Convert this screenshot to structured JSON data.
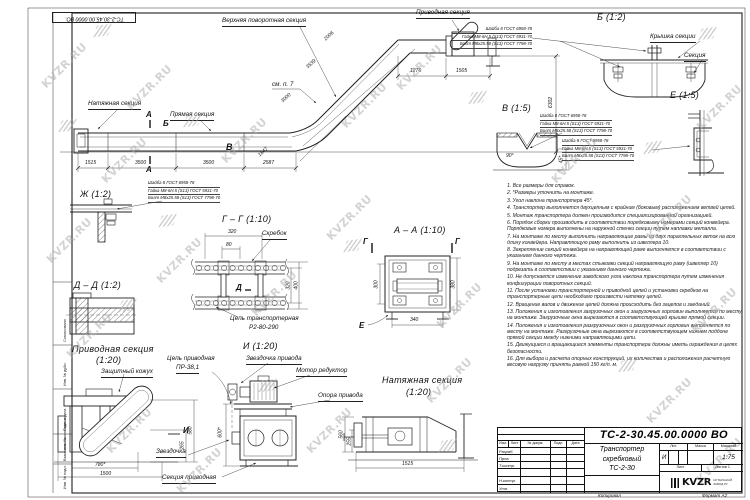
{
  "sheet": {
    "stamp_number": "ТС-2-30.45.00.0000 ВО.",
    "copied_label": "Копировал",
    "format_label": "Формат А2"
  },
  "watermark": {
    "text": "KVZR.RU"
  },
  "margin_labels": {
    "agreed": "Согласовано",
    "inv_dup": "Инв. № дубл.",
    "sign_date": "Подп. и дата",
    "repl_inv": "Взам. инв. №",
    "inv_orig": "Инв. № подл."
  },
  "main_view": {
    "tension_label": "Натяжная секция",
    "straight_label": "Прямая секция",
    "upper_turn_label": "Верхняя поворотная секция",
    "drive_label": "Приводная секция",
    "see_note": "см. п. 7",
    "mark_a": "А",
    "mark_b": "Б",
    "mark_v": "В",
    "dims": {
      "d1515": "1515",
      "d3500a": "3500",
      "d3500b": "3500",
      "d2587": "2587",
      "d1847": "1847",
      "d3000": "3000",
      "d3539": "3539",
      "d2006": "2006",
      "d1276": "1276",
      "d1505": "1505",
      "d6302": "6302"
    }
  },
  "fasteners": {
    "washer": "Шайба 8 ГОСТ 6958-78",
    "nut": "Гайка М8-6Н.5 (S13) ГОСТ 5931-70",
    "bolt": "Болт М8х25.58 (S13) ГОСТ 7798-70"
  },
  "details": {
    "b": {
      "title": "Б (1:2)",
      "cover_label": "Крышка секции",
      "section_label": "Секция"
    },
    "v": {
      "title": "В (1:5)",
      "angle90": "90°",
      "dim45": "45*"
    },
    "e": {
      "title": "Е (1:5)"
    },
    "zh": {
      "title": "Ж (1:2)"
    },
    "dd": {
      "title": "Д – Д (1:2)"
    },
    "gg": {
      "title": "Г – Г (1:10)",
      "scraper_label": "Скребок",
      "chain_label1": "Цепь транспортерная",
      "chain_label2": "Р2-80-290",
      "mark_d": "Д",
      "dim_w": "320",
      "dim_w2": "80",
      "dim_h1": "320",
      "dim_h2": "400"
    },
    "aa": {
      "title": "А – А (1:10)",
      "mark_g1": "Г",
      "mark_g2": "Г",
      "mark_e": "Е",
      "dim_left": "300",
      "dim_right": "380",
      "dim_bottom": "340"
    },
    "i": {
      "title": "И (1:20)",
      "chain_label1": "Цепь приводная",
      "chain_label2": "ПР-38,1",
      "drive_sprocket_label": "Звездочка привода",
      "motor_label": "Мотор редуктор",
      "support_label": "Опора привода",
      "sprocket_label": "Звездочка",
      "drive_section_label": "Секция приводная",
      "dim_h": "600*"
    },
    "drive_view": {
      "title": "Приводная секция",
      "scale": "(1:20)",
      "guard_label": "Защитный кожух",
      "mark_i": "И",
      "dim1": "780*",
      "dim2": "1500",
      "dim3": "265",
      "dim4": "560"
    },
    "tension_view": {
      "title": "Натяжная секция",
      "scale": "(1:20)",
      "dim1": "560",
      "dim2": "255",
      "dim3": "1515"
    }
  },
  "notes": [
    "1. Все размеры для справок.",
    "2. *Размеры уточнить на монтаже.",
    "3. Угол наклона транспортера 45°.",
    "4. Транспортер выполняется двухцепным с крайним (боковым) расположением ветвей цепей.",
    "5. Монтаж транспортера должен производится специализированной организацией.",
    "6. Порядок сборки производить в соответствии порядковыми номерами секций конвейера. Порядковые номера выполнены на наружной стенки секции путем наплавки металла.",
    "7. На монтаже по месту выполнить направляющие рамы из двух параллельных веток на всю длину конвейера. Направляющую раму выполнить из швеллера 10.",
    "8. Закрепление секций конвейера на направляющей раме выполняется в соответствии с указанием данного чертежа.",
    "9. На монтаже по месту в местах стыковки секций направляющую раму (швеллер 10) подрезать в соответствии с указанием данного чертежа.",
    "10. Не допускается изменение заводского угла наклона транспортера путем изменения конфигурации поворотных секций.",
    "11. После установки транспортерной и приводной цепей и установки скребков на транспортерные цепи необходимо произвести натяжку цепей.",
    "12. Вращение валов и движение цепей должна происходить без зацепов и заеданий.",
    "13. Положения и изготовления загрузочных окон и загрузочных горловин выполняется по месту на монтаже. Загрузочные окна вырезаются в соответствующей крышке прямой секции.",
    "14. Положения и изготовления разгрузочных окон и разгрузочных горловин выполняется по месту на монтаже. Разгрузочные окна вырезаются в соответствующем нижнем поддоне прямой секции между нижними направляющими цепи.",
    "15. Движущиеся и вращающиеся элементы транспортера должны иметь ограждения в целях безопасности.",
    "16. Для выбора и расчета опорных конструкций, их количества и расположения расчетную весовую нагрузку принять равной 150 кг/п. м."
  ],
  "title_block": {
    "number": "ТС-2-30.45.00.0000 ВО",
    "name_line1": "Транспортер",
    "name_line2": "скребковый",
    "name_line3": "ТС-2-30",
    "col_izm": "Изм.",
    "col_list": "Лист",
    "col_doc": "№ докум.",
    "col_sign": "Подп.",
    "col_date": "Дата",
    "row_dev": "Разраб.",
    "row_check": "Пров.",
    "row_tcontr": "Т.контр.",
    "row_ncontr": "Н.контр.",
    "row_approve": "Утв.",
    "lit_header": "Лит.",
    "mass_header": "Масса",
    "scale_header": "Масштаб",
    "lit_value": "И",
    "scale_value": "1:75",
    "sheet_header": "Лист",
    "sheets_header": "Листов",
    "sheets_value": "1",
    "logo_text": "KVZR",
    "logo_sub1": "КОТЕЛЬНЫЙ",
    "logo_sub2": "ЗАВОД.РУ"
  }
}
